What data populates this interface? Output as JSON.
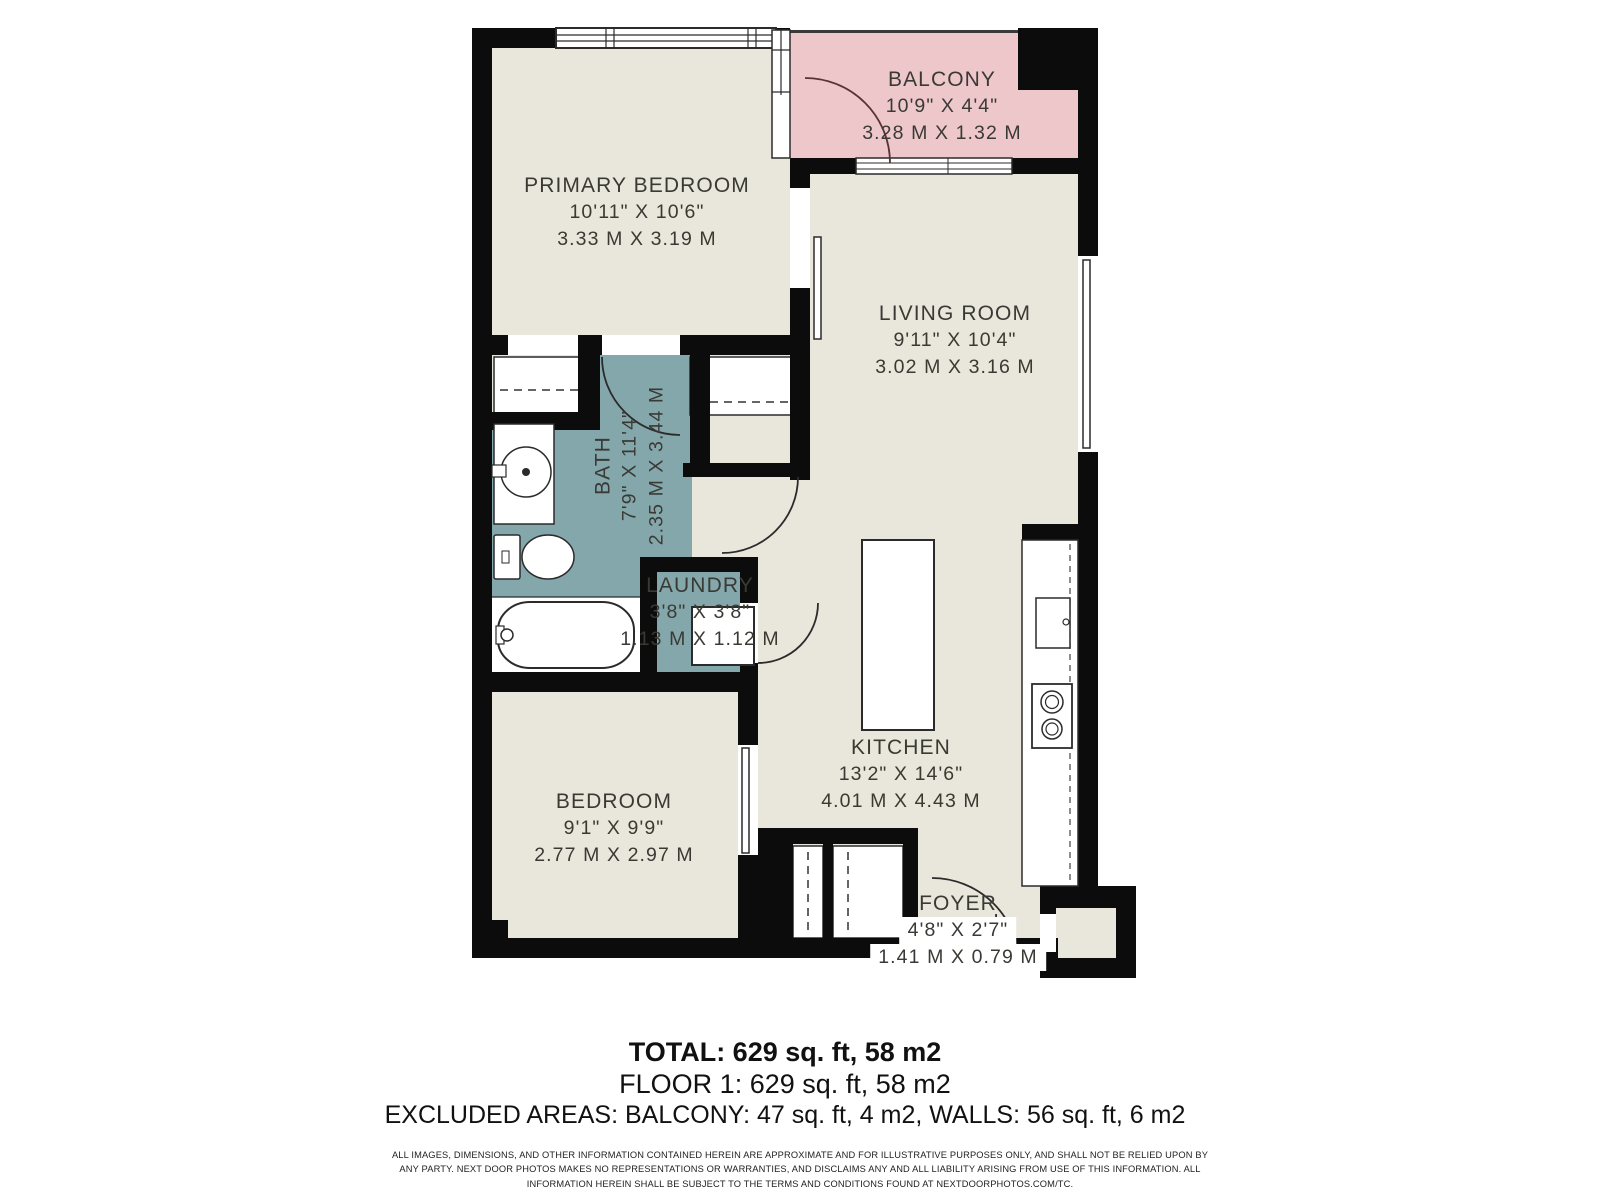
{
  "floor_plan": {
    "rooms": [
      {
        "id": "balcony",
        "name": "BALCONY",
        "imperial": "10'9\" X 4'4\"",
        "metric": "3.28 M X 1.32 M"
      },
      {
        "id": "primary-bedroom",
        "name": "PRIMARY BEDROOM",
        "imperial": "10'11\" X 10'6\"",
        "metric": "3.33 M X 3.19 M"
      },
      {
        "id": "living-room",
        "name": "LIVING ROOM",
        "imperial": "9'11\" X 10'4\"",
        "metric": "3.02 M X 3.16 M"
      },
      {
        "id": "bath",
        "name": "BATH",
        "imperial": "7'9\" X 11'4\"",
        "metric": "2.35 M X 3.44 M"
      },
      {
        "id": "laundry",
        "name": "LAUNDRY",
        "imperial": "3'8\" X 3'8\"",
        "metric": "1.13 M X 1.12 M"
      },
      {
        "id": "bedroom",
        "name": "BEDROOM",
        "imperial": "9'1\" X 9'9\"",
        "metric": "2.77 M X 2.97 M"
      },
      {
        "id": "kitchen",
        "name": "KITCHEN",
        "imperial": "13'2\" X 14'6\"",
        "metric": "4.01 M X 4.43 M"
      },
      {
        "id": "foyer",
        "name": "FOYER",
        "imperial": "4'8\" X 2'7\"",
        "metric": "1.41 M X 0.79 M"
      }
    ],
    "colors": {
      "wall": "#0c0c0c",
      "floor": "#e9e6db",
      "wet_area": "#84a7ac",
      "balcony": "#eec7cb",
      "label_text": "#3a3a35"
    }
  },
  "summary": {
    "total": "TOTAL: 629 sq. ft, 58 m2",
    "floor": "FLOOR 1: 629 sq. ft, 58 m2",
    "excluded": "EXCLUDED AREAS: BALCONY: 47 sq. ft, 4 m2, WALLS: 56 sq. ft, 6 m2"
  },
  "disclaimer": "ALL IMAGES, DIMENSIONS, AND OTHER INFORMATION CONTAINED HEREIN ARE APPROXIMATE AND FOR ILLUSTRATIVE PURPOSES ONLY, AND SHALL NOT BE RELIED UPON BY ANY PARTY. NEXT DOOR PHOTOS MAKES NO REPRESENTATIONS OR WARRANTIES, AND DISCLAIMS ANY AND ALL LIABILITY ARISING FROM USE OF THIS INFORMATION. ALL INFORMATION HEREIN SHALL BE SUBJECT TO THE TERMS AND CONDITIONS FOUND AT NEXTDOORPHOTOS.COM/TC."
}
